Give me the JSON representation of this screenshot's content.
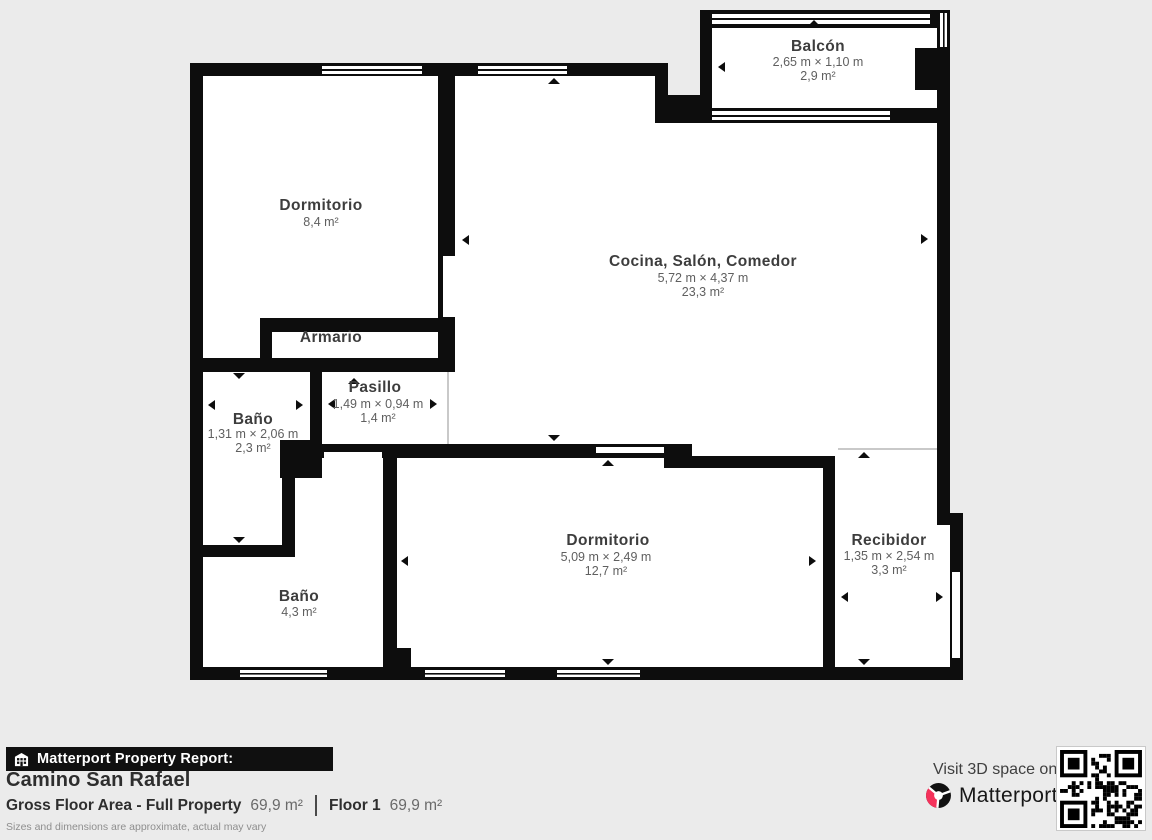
{
  "report_bar": {
    "label": "Matterport Property Report:"
  },
  "property": {
    "name": "Camino San Rafael",
    "gross_floor_area_label": "Gross Floor Area - Full Property",
    "gross_floor_area_value": "69,9 m²",
    "floor_label": "Floor 1",
    "floor_value": "69,9 m²",
    "disclaimer": "Sizes and dimensions are approximate, actual may vary"
  },
  "footer_cta": {
    "visit_text": "Visit 3D space on",
    "brand": "Matterport",
    "brand_mark": "™"
  },
  "floorplan": {
    "rooms": {
      "balcon": {
        "name": "Balcón",
        "dims": "2,65 m × 1,10 m",
        "area": "2,9 m²"
      },
      "dormitorio1": {
        "name": "Dormitorio",
        "area": "8,4 m²"
      },
      "cocina": {
        "name": "Cocina, Salón, Comedor",
        "dims": "5,72 m × 4,37 m",
        "area": "23,3 m²"
      },
      "armario": {
        "name": "Armario"
      },
      "pasillo": {
        "name": "Pasillo",
        "dims": "1,49 m × 0,94 m",
        "area": "1,4 m²"
      },
      "bano1": {
        "name": "Baño",
        "dims": "1,31 m × 2,06 m",
        "area": "2,3 m²"
      },
      "dormitorio2": {
        "name": "Dormitorio",
        "dims": "5,09 m × 2,49 m",
        "area": "12,7 m²"
      },
      "recibidor": {
        "name": "Recibidor",
        "dims": "1,35 m × 2,54 m",
        "area": "3,3 m²"
      },
      "bano2": {
        "name": "Baño",
        "area": "4,3 m²"
      }
    },
    "colors": {
      "wall": "#0d0d0d",
      "room": "#ffffff",
      "open_boundary": "#c9c9c9"
    }
  }
}
